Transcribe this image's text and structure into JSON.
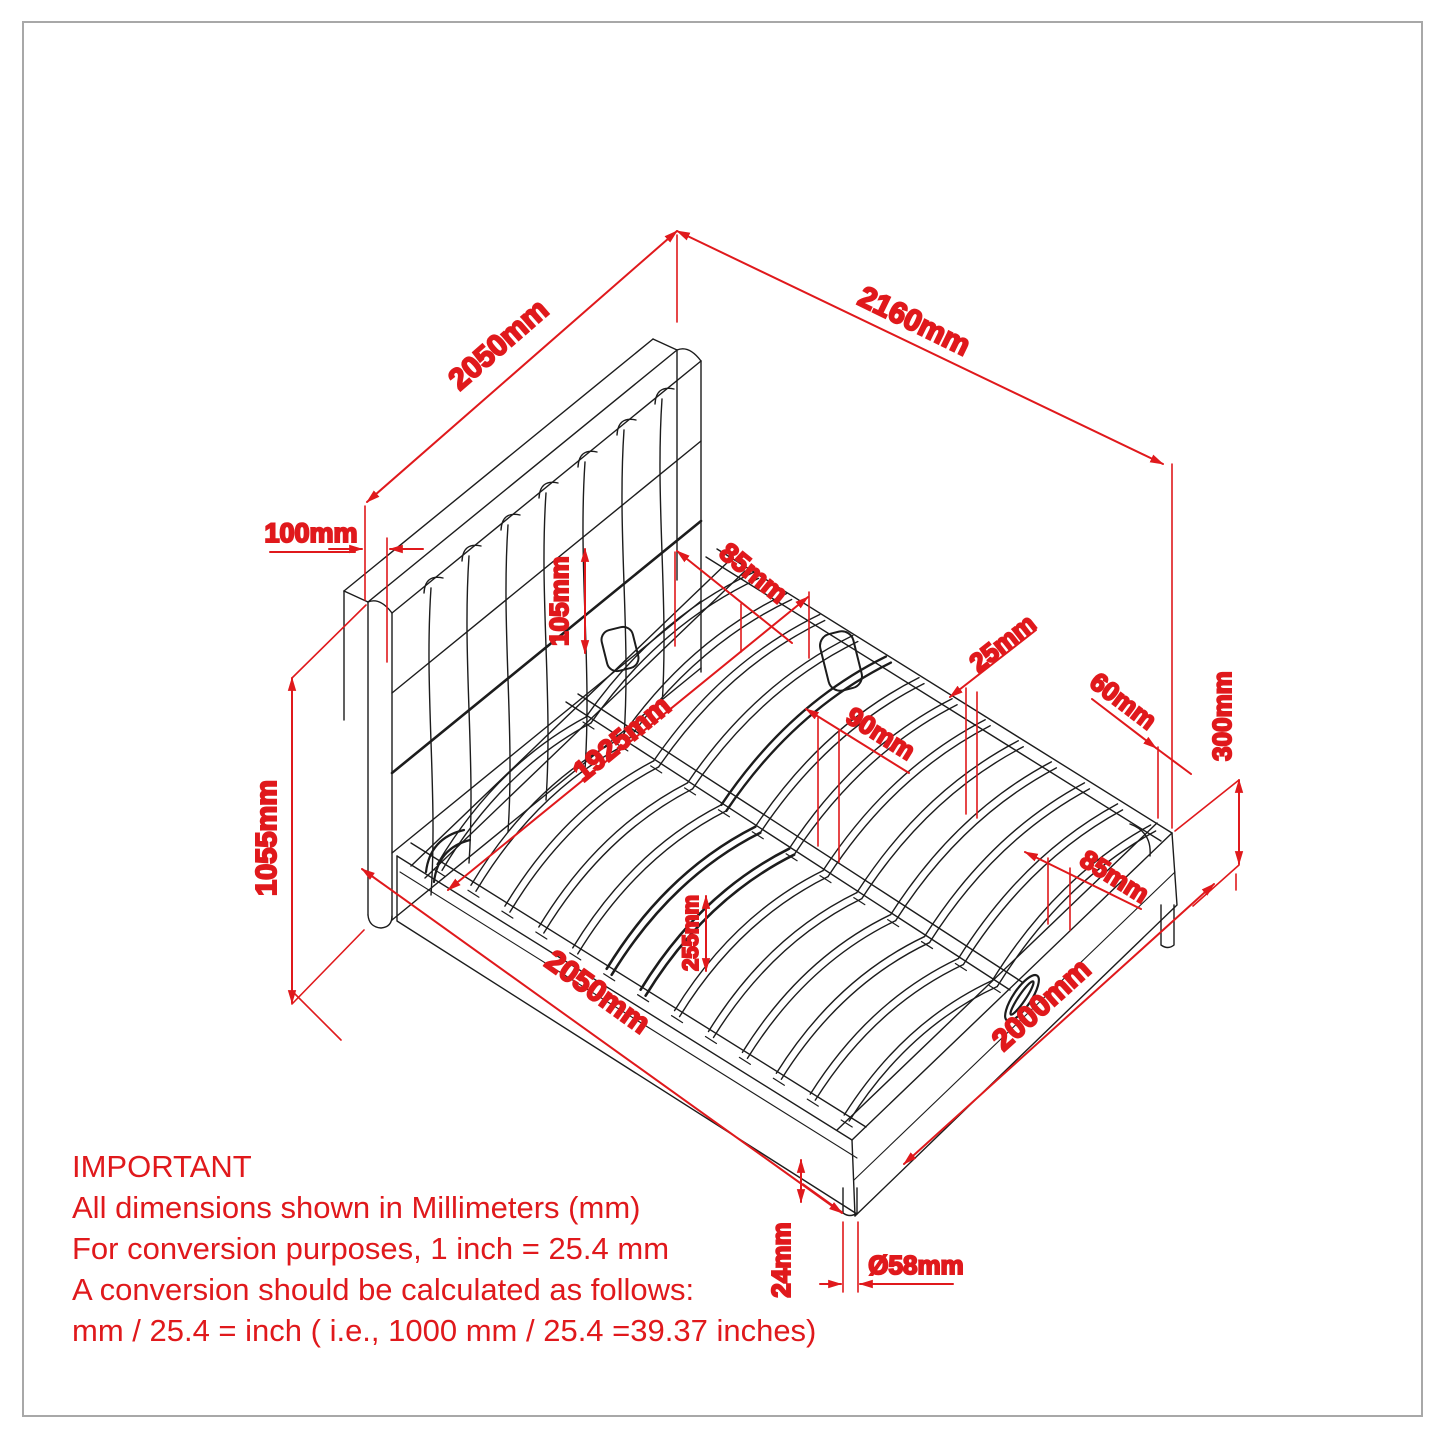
{
  "note": {
    "title": "IMPORTANT",
    "lines": [
      "All dimensions shown in Millimeters (mm)",
      "For conversion purposes, 1 inch = 25.4 mm",
      "A conversion should be calculated as follows:",
      "mm / 25.4 = inch ( i.e., 1000 mm / 25.4 =39.37 inches)"
    ]
  },
  "colors": {
    "dimension_red": "#e0191c",
    "drawing_black": "#1c1c1c",
    "sheet_border_gray": "#a8a8a8",
    "background": "#ffffff"
  },
  "dims": {
    "headboard_width_top": "2050mm",
    "overall_length": "2160mm",
    "headboard_thickness": "100mm",
    "headboard_clearance": "105mm",
    "head_rail_width": "85mm",
    "inner_width": "1925mm",
    "slat_thickness": "25mm",
    "slat_spacing": "90mm",
    "corner_offset": "60mm",
    "rail_height": "300mm",
    "foot_rail_width": "85mm",
    "slat_ref": "255mm",
    "side_rail_length": "2050mm",
    "platform_length": "2000mm",
    "leg_pad_height": "24mm",
    "leg_diameter": "Ø58mm",
    "headboard_height": "1055mm"
  }
}
